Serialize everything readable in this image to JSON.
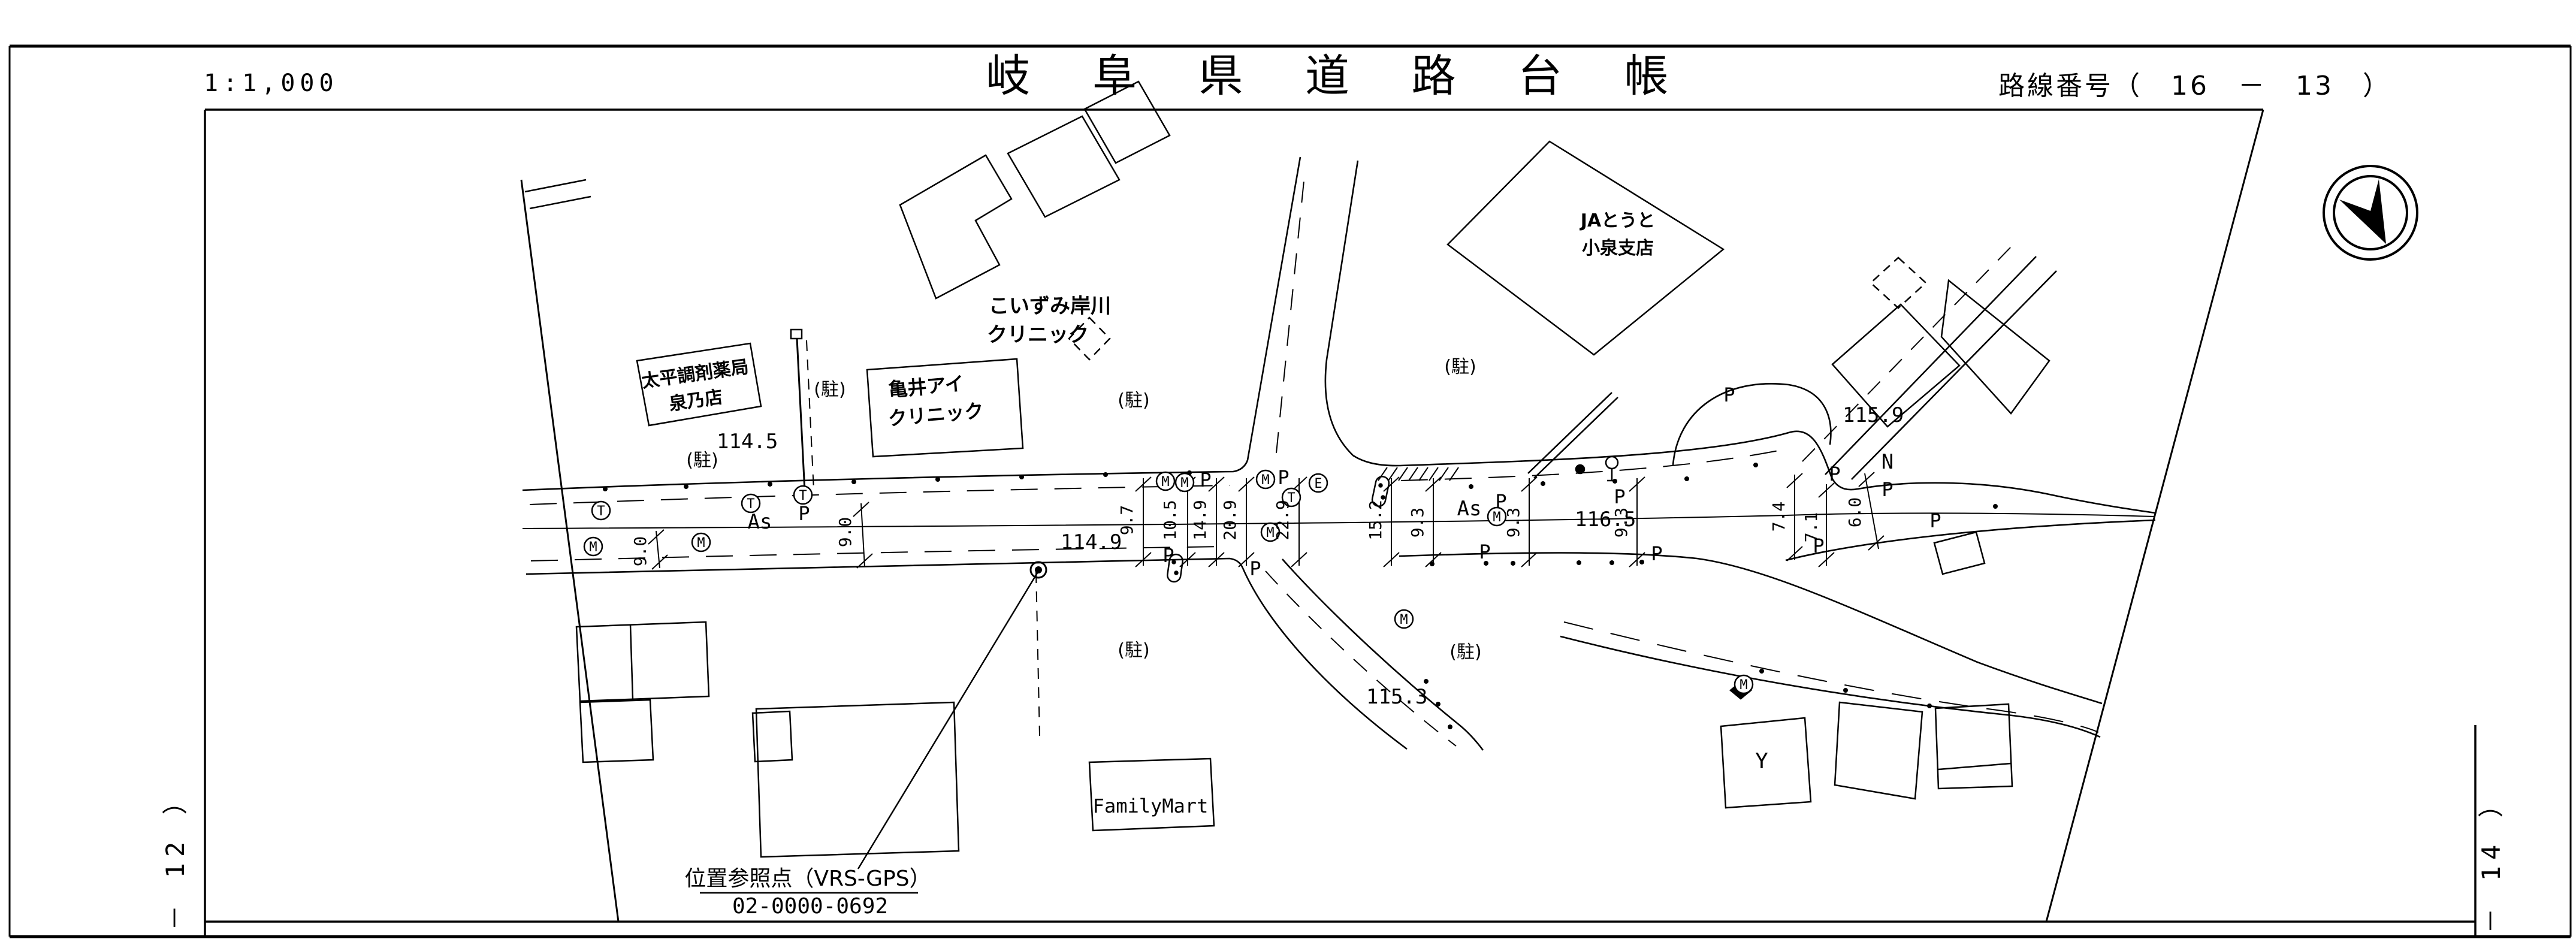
{
  "header": {
    "scale": "1:1,000",
    "title": "岐 阜 県 道 路 台 帳",
    "route_number": "路線番号（　16　－　13　）"
  },
  "margins": {
    "left": "－ 12 ）",
    "right": "－ 14 ）"
  },
  "map": {
    "labels": {
      "ja_line1": "JAとうと",
      "ja_line2": "小泉支店",
      "koizumi_line1": "こいずみ岸川",
      "koizumi_line2": "クリニック",
      "taihei_line1": "太平調剤薬局",
      "taihei_line2": "泉乃店",
      "kamei_line1": "亀井アイ",
      "kamei_line2": "クリニック",
      "familymart": "FamilyMart",
      "vrs_line1": "位置参照点（VRS-GPS）",
      "vrs_line2": "02-0000-0692",
      "parking": "(駐)",
      "as": "As",
      "n": "N",
      "y": "Y",
      "p": "P"
    },
    "elevations": {
      "e1": "114.5",
      "e2": "114.9",
      "e3": "115.3",
      "e4": "115.9",
      "e5": "116.5"
    },
    "dimensions": {
      "d1": "9.0",
      "d2": "9.7",
      "d3": "10.5",
      "d4": "14.9",
      "d5": "20.9",
      "d6": "22.9",
      "d7": "15.2",
      "d8": "9.3",
      "d9": "9.3",
      "d10": "9.3",
      "d11": "7.4",
      "d12": "7.1",
      "d13": "6.0",
      "d14": "9.0"
    },
    "symbols": {
      "s1": "T",
      "s2": "M",
      "s3": "M",
      "s4": "T",
      "s5": "T",
      "s6": "M",
      "s7": "M",
      "s8": "M",
      "s9": "T",
      "s10": "E",
      "s11": "M",
      "s12": "M",
      "s13": "M",
      "s14": "M"
    },
    "colors": {
      "ink": "#000000",
      "paper": "#ffffff"
    }
  }
}
